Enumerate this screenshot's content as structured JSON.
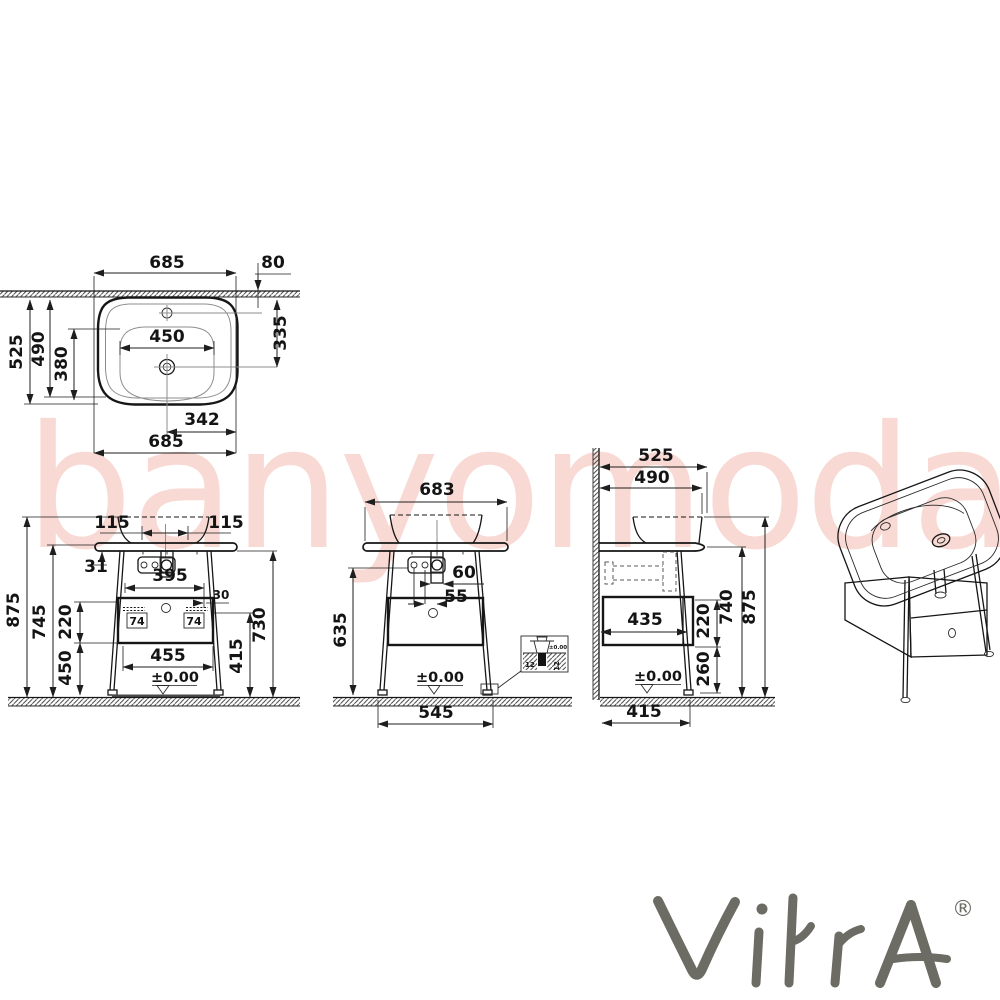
{
  "watermark": {
    "text": "banyomoda"
  },
  "brand": {
    "name": "VitrA",
    "reg": "®"
  },
  "top_view": {
    "w_top": "685",
    "offset": "80",
    "d525": "525",
    "d490": "490",
    "d380": "380",
    "w450": "450",
    "d335": "335",
    "d342": "342",
    "w_bottom": "685"
  },
  "front_view": {
    "tap_l": "115",
    "tap_r": "115",
    "t31": "31",
    "w395": "395",
    "o30": "30",
    "h74_l": "74",
    "h74_r": "74",
    "h875": "875",
    "h745": "745",
    "h220": "220",
    "h450": "450",
    "w455": "455",
    "h415": "415",
    "h730": "730",
    "datum": "±0.00"
  },
  "mid_view": {
    "w683": "683",
    "o60": "60",
    "o55": "55",
    "h635": "635",
    "w545": "545",
    "datum": "±0.00",
    "detail": {
      "n12_l": "12",
      "n12_r": "12",
      "datum": "±0.00"
    }
  },
  "side_view": {
    "d525": "525",
    "d490": "490",
    "d435": "435",
    "h220": "220",
    "h740": "740",
    "h875": "875",
    "h260": "260",
    "w415": "415",
    "datum": "±0.00"
  }
}
